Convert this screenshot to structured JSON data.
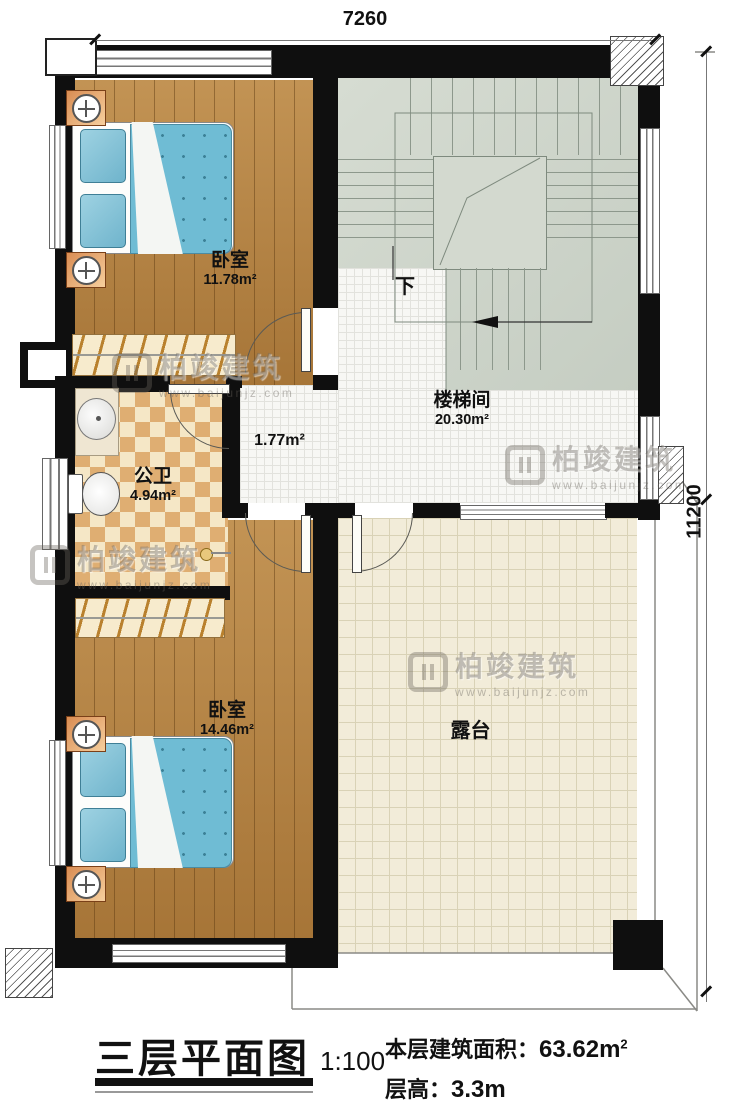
{
  "dimensions": {
    "top": "7260",
    "right": "11200"
  },
  "rooms": {
    "bedroom_top": {
      "name": "卧室",
      "area": "11.78m²"
    },
    "stairwell": {
      "name": "楼梯间",
      "area": "20.30m²"
    },
    "hallway": {
      "area": "1.77m²"
    },
    "bathroom": {
      "name": "公卫",
      "area": "4.94m²"
    },
    "bedroom_bottom": {
      "name": "卧室",
      "area": "14.46m²"
    },
    "terrace": {
      "name": "露台"
    }
  },
  "stairs": {
    "down_label": "下"
  },
  "title_block": {
    "title": "三层平面图",
    "scale": "1:100",
    "area_label": "本层建筑面积：",
    "area_value": "63.62m",
    "area_sup": "2",
    "height_label": "层高：",
    "height_value": "3.3m"
  },
  "watermark": {
    "brand": "柏竣建筑",
    "url": "www.baijunjz.com"
  },
  "colors": {
    "wall": "#0f0f0f",
    "wood": "#b5813f",
    "stair_floor": "#ced5cb",
    "terrace_tile": "#f2ecd9",
    "checker": "#dfae72",
    "mattress": "#6fbcd4"
  }
}
